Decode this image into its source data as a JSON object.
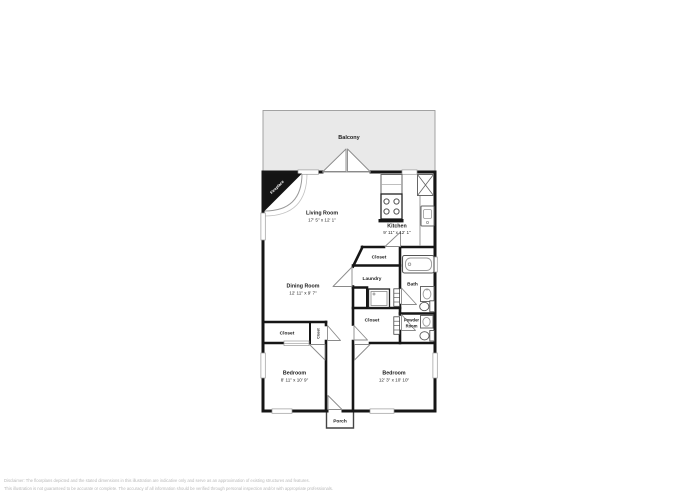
{
  "image": {
    "type": "residential floor plan"
  },
  "colors": {
    "wall": "#161616",
    "balcony_fill": "#e9e9e9",
    "thin_line": "#9a9a9a",
    "disclaimer_text": "#b9b9b9"
  },
  "icons": [
    "fireplace-icon",
    "french-doors-icon",
    "stove-icon",
    "refrigerator-icon",
    "kitchen-sink-icon",
    "bathtub-icon",
    "toilet-icon",
    "vanity-sink-icon",
    "washer-icon",
    "door-swing-icon",
    "window-icon",
    "bifold-door-icon"
  ],
  "rooms": {
    "balcony": {
      "label": "Balcony"
    },
    "fireplace": {
      "label": "Fireplace"
    },
    "living_room": {
      "name": "Living Room",
      "dims": "17' 5\" x 12' 1\""
    },
    "kitchen": {
      "name": "Kitchen",
      "dims": "9' 11\" x 12' 1\""
    },
    "dining_room": {
      "name": "Dining Room",
      "dims": "12' 11\" x 9' 7\""
    },
    "closet_pantry": {
      "label": "Closet"
    },
    "laundry": {
      "label": "Laundry"
    },
    "bath": {
      "label": "Bath"
    },
    "closet_hall": {
      "label": "Closet"
    },
    "powder_room": {
      "label_line1": "Powder",
      "label_line2": "Room"
    },
    "closet_bedroom": {
      "label": "Closet"
    },
    "closet_small": {
      "label": "Closet"
    },
    "bedroom_left": {
      "name": "Bedroom",
      "dims": "8' 11\" x 10' 9\""
    },
    "bedroom_right": {
      "name": "Bedroom",
      "dims": "12' 3\" x 10' 10\""
    },
    "porch": {
      "label": "Porch"
    }
  },
  "footer": {
    "disclaimer_line1": "Disclaimer: The floorplans depicted and the stated dimensions in this illustration are indicative only and serve as an approximation of existing structures and features.",
    "disclaimer_line2": "This illustration is not guaranteed to be accurate or complete. The accuracy of all information should be verified through personal inspection and/or with appropriate professionals."
  }
}
